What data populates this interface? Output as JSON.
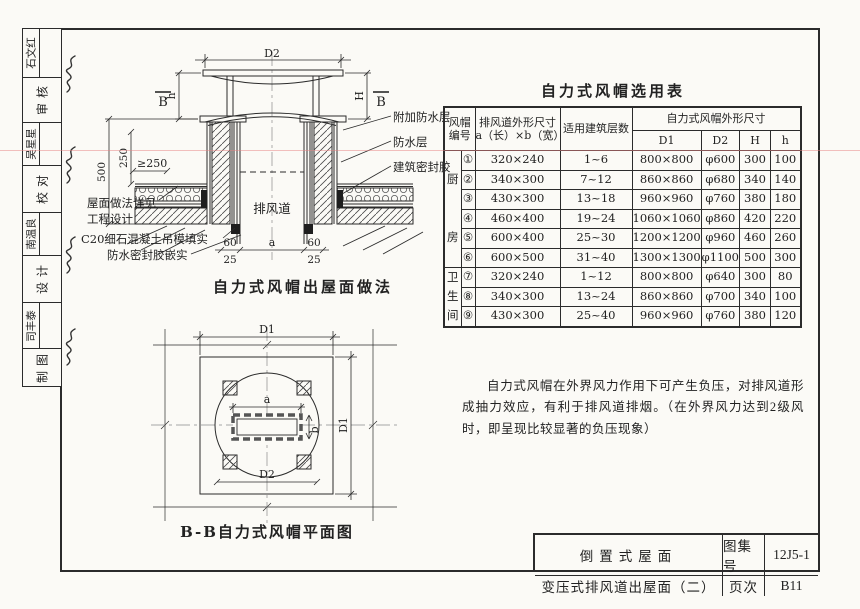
{
  "colors": {
    "frame": "#2b2b2b",
    "paper": "#fbfaf6",
    "scan_line": "#e88282",
    "sealant": "#1e1e1e"
  },
  "sidebar": {
    "cells": [
      {
        "type": "name",
        "text": "石文红"
      },
      {
        "type": "label",
        "text": "审 核"
      },
      {
        "type": "name",
        "text": "吴星星"
      },
      {
        "type": "label",
        "text": "校 对"
      },
      {
        "type": "name",
        "text": "南温良"
      },
      {
        "type": "label",
        "text": "设 计"
      },
      {
        "type": "name",
        "text": "司丰泰"
      },
      {
        "type": "label",
        "text": "制 图"
      }
    ]
  },
  "section_drawing": {
    "caption": "自力式风帽出屋面做法",
    "duct_label": "排风道",
    "dim_d2": "D2",
    "dim_h": "h",
    "dim_H": "H",
    "mark_b_left": "B",
    "mark_b_right": "B",
    "dim_500": "500",
    "dim_250": "250",
    "dim_ge250": "≥250",
    "dim_60_left": "60",
    "dim_a": "a",
    "dim_60_right": "60",
    "dim_25_left": "25",
    "dim_25_right": "25",
    "label_addl_waterproof": "附加防水层",
    "label_waterproof": "防水层",
    "label_building_sealant": "建筑密封胶",
    "label_roof_note_line1": "屋面做法详见",
    "label_roof_note_line2": "工程设计",
    "label_c20": "C20细石混凝土吊模填实",
    "label_wp_sealant": "防水密封胶嵌实"
  },
  "plan_drawing": {
    "caption": "B-B自力式风帽平面图",
    "dim_d1_top": "D1",
    "dim_d1_right": "D1",
    "dim_d2": "D2",
    "dim_a": "a",
    "dim_b": "b"
  },
  "selection_table": {
    "title": "自力式风帽选用表",
    "headers": {
      "cap_no_line1": "风帽",
      "cap_no_line2": "编号",
      "duct_line1": "排风道外形尺寸",
      "duct_line2": "a（长）×b（宽）",
      "floors": "适用建筑层数",
      "cap_size": "自力式风帽外形尺寸",
      "d1": "D1",
      "d2": "D2",
      "H": "H",
      "h": "h"
    },
    "groups": [
      {
        "label": "厨房",
        "span": 6
      },
      {
        "label": "卫生间",
        "span": 3
      }
    ],
    "rows": [
      {
        "num": "①",
        "duct": "320×240",
        "floors": "1~6",
        "d1": "800×800",
        "d2": "φ600",
        "H": "300",
        "h": "100"
      },
      {
        "num": "②",
        "duct": "340×300",
        "floors": "7~12",
        "d1": "860×860",
        "d2": "φ680",
        "H": "340",
        "h": "140"
      },
      {
        "num": "③",
        "duct": "430×300",
        "floors": "13~18",
        "d1": "960×960",
        "d2": "φ760",
        "H": "380",
        "h": "180"
      },
      {
        "num": "④",
        "duct": "460×400",
        "floors": "19~24",
        "d1": "1060×1060",
        "d2": "φ860",
        "H": "420",
        "h": "220"
      },
      {
        "num": "⑤",
        "duct": "600×400",
        "floors": "25~30",
        "d1": "1200×1200",
        "d2": "φ960",
        "H": "460",
        "h": "260"
      },
      {
        "num": "⑥",
        "duct": "600×500",
        "floors": "31~40",
        "d1": "1300×1300",
        "d2": "φ1100",
        "H": "500",
        "h": "300"
      },
      {
        "num": "⑦",
        "duct": "320×240",
        "floors": "1~12",
        "d1": "800×800",
        "d2": "φ640",
        "H": "300",
        "h": "80"
      },
      {
        "num": "⑧",
        "duct": "340×300",
        "floors": "13~24",
        "d1": "860×860",
        "d2": "φ700",
        "H": "340",
        "h": "100"
      },
      {
        "num": "⑨",
        "duct": "430×300",
        "floors": "25~40",
        "d1": "960×960",
        "d2": "φ760",
        "H": "380",
        "h": "120"
      }
    ]
  },
  "note": {
    "text": "自力式风帽在外界风力作用下可产生负压，对排风道形成抽力效应，有利于排风道排烟。（在外界风力达到2级风时，即呈现比较显著的负压现象）"
  },
  "title_block": {
    "project_line1": "倒置式屋面",
    "project_line2": "变压式排风道出屋面（二）",
    "atlas_label": "图集号",
    "atlas_no": "12J5-1",
    "page_label": "页次",
    "page_no": "B11"
  }
}
